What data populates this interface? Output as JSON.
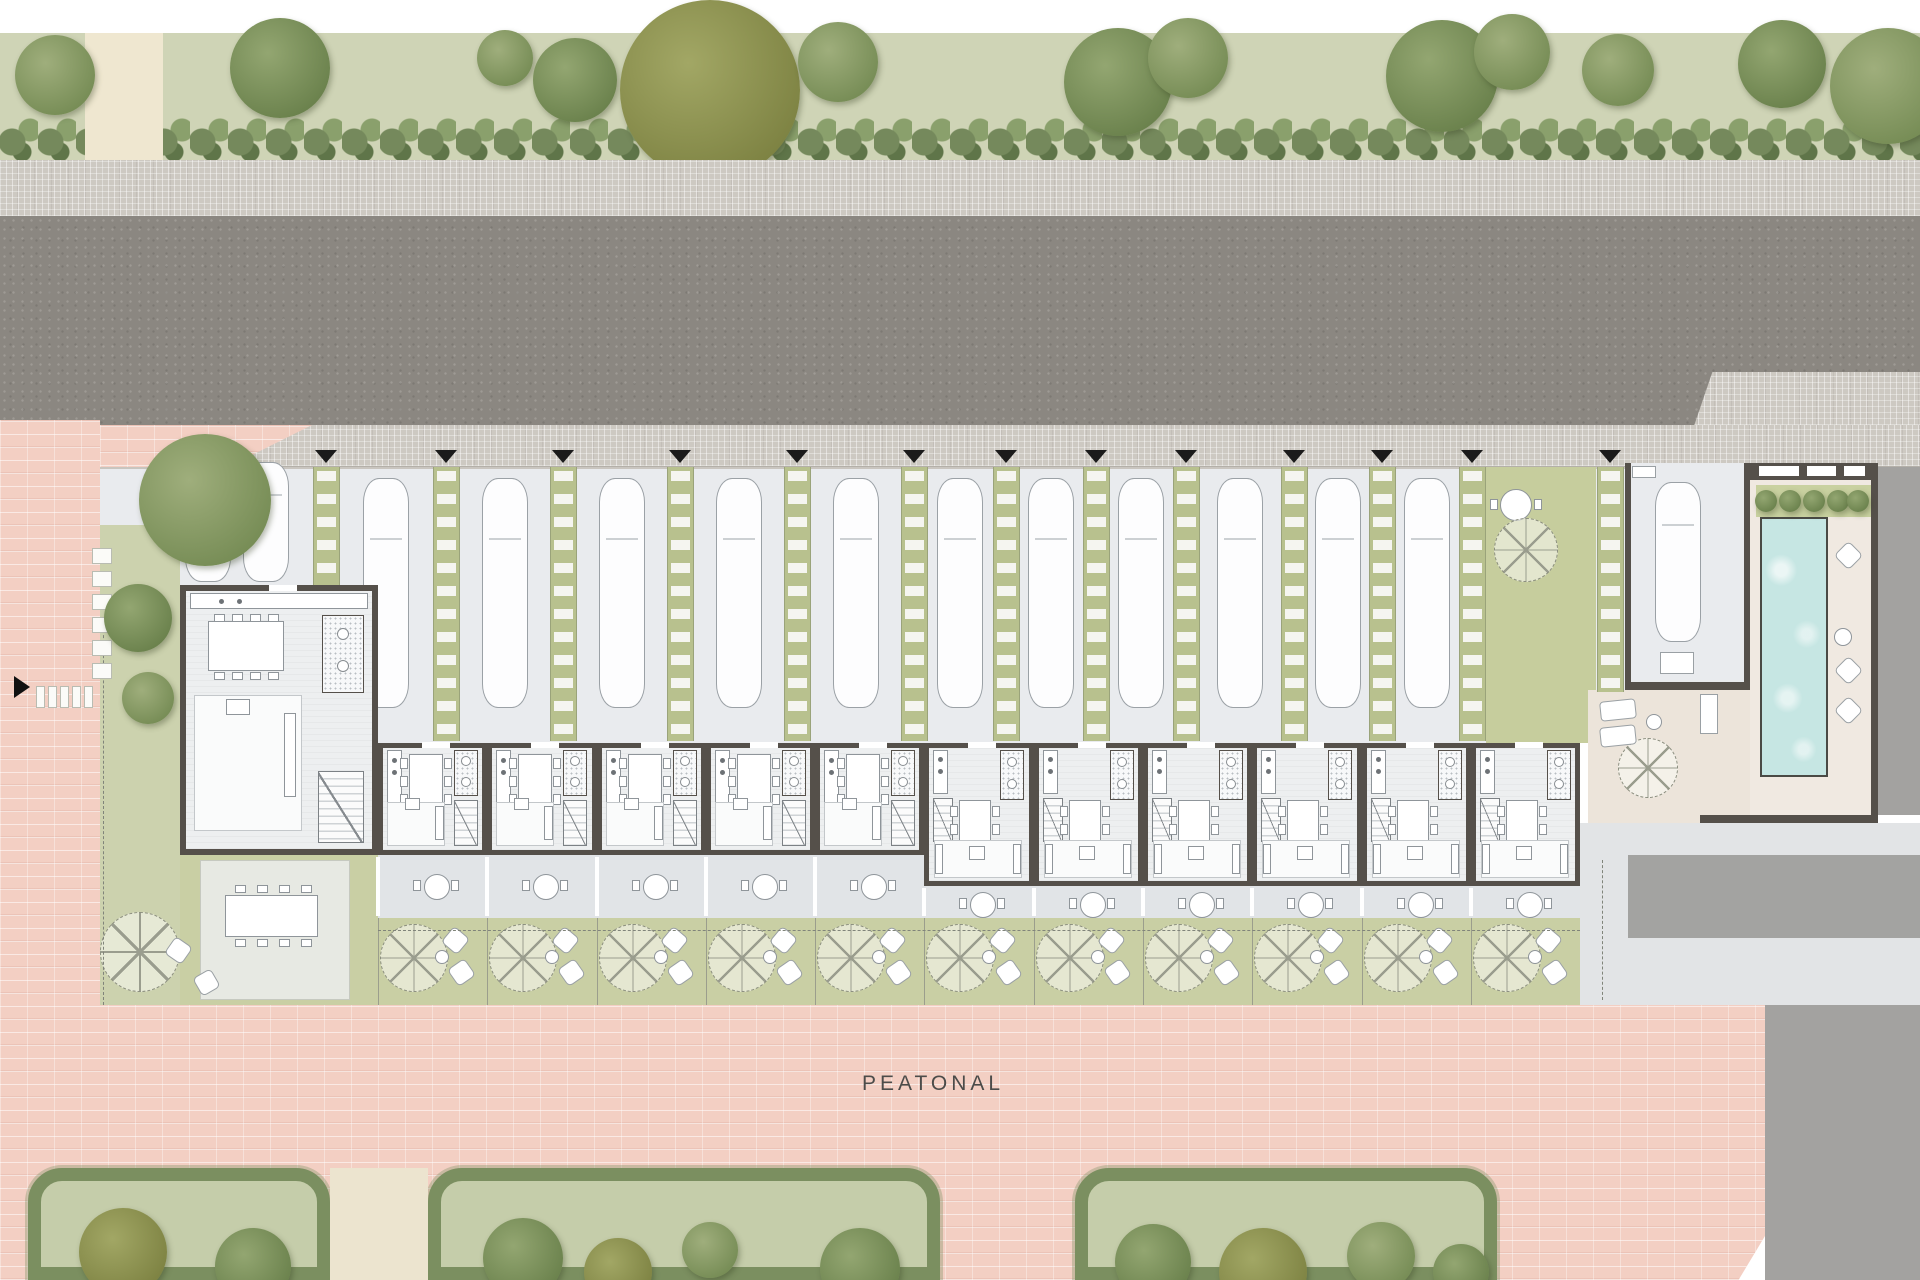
{
  "labels": {
    "pedestrian_street": "PEATONAL"
  },
  "colors": {
    "asphalt": "#8b8781",
    "sidewalk": "#cdc9c2",
    "parking": "#e9ebee",
    "lawn": "#ccd2ae",
    "hedge": "#7b8f60",
    "pink_paving": "#f3cfc3",
    "wall": "#55504a",
    "floor": "#edeff0",
    "terrace": "#e1e4e7",
    "garden": "#c9cfa4",
    "pool_water": "#c6e6e3",
    "deck": "#f0e9e1",
    "communal_beige": "#ece4da",
    "marker": "#1b1b1b",
    "tree_a": [
      "#9fae7c",
      "#768c55"
    ],
    "tree_b": [
      "#93a671",
      "#6a814c"
    ],
    "tree_olive": [
      "#a2a765",
      "#7d8242"
    ]
  },
  "top_strip": {
    "path": {
      "x": 85,
      "w": 78
    },
    "trees": [
      {
        "x": 55,
        "y": 75,
        "r": 40,
        "c": "a"
      },
      {
        "x": 280,
        "y": 68,
        "r": 50,
        "c": "b"
      },
      {
        "x": 505,
        "y": 58,
        "r": 28,
        "c": "a"
      },
      {
        "x": 575,
        "y": 80,
        "r": 42,
        "c": "b"
      },
      {
        "x": 710,
        "y": 90,
        "r": 90,
        "c": "o"
      },
      {
        "x": 838,
        "y": 62,
        "r": 40,
        "c": "a"
      },
      {
        "x": 1118,
        "y": 82,
        "r": 54,
        "c": "b"
      },
      {
        "x": 1188,
        "y": 58,
        "r": 40,
        "c": "a"
      },
      {
        "x": 1442,
        "y": 76,
        "r": 56,
        "c": "b"
      },
      {
        "x": 1512,
        "y": 52,
        "r": 38,
        "c": "a"
      },
      {
        "x": 1618,
        "y": 70,
        "r": 36,
        "c": "a"
      },
      {
        "x": 1782,
        "y": 64,
        "r": 44,
        "c": "b"
      },
      {
        "x": 1888,
        "y": 86,
        "r": 58,
        "c": "a"
      }
    ]
  },
  "parking": {
    "strips": [
      {
        "x": 326
      },
      {
        "x": 446
      },
      {
        "x": 563
      },
      {
        "x": 680
      },
      {
        "x": 797
      },
      {
        "x": 914
      },
      {
        "x": 1006
      },
      {
        "x": 1096
      },
      {
        "x": 1186
      },
      {
        "x": 1294
      },
      {
        "x": 1382
      },
      {
        "x": 1472
      },
      {
        "x": 1610,
        "h": 225
      }
    ],
    "markers": [
      326,
      446,
      563,
      680,
      797,
      914,
      1006,
      1096,
      1186,
      1294,
      1382,
      1472,
      1610
    ],
    "cars": [
      {
        "x": 208,
        "y": 462,
        "l": 120
      },
      {
        "x": 266,
        "y": 462,
        "l": 120
      },
      {
        "x": 386
      },
      {
        "x": 505
      },
      {
        "x": 622
      },
      {
        "x": 739
      },
      {
        "x": 856
      },
      {
        "x": 960
      },
      {
        "x": 1051
      },
      {
        "x": 1141
      },
      {
        "x": 1240
      },
      {
        "x": 1338
      },
      {
        "x": 1427
      },
      {
        "x": 1678,
        "y": 482,
        "l": 160
      }
    ]
  },
  "units": [
    {
      "x": 180,
      "w": 198,
      "type": "end"
    },
    {
      "x": 378,
      "w": 109,
      "type": "A"
    },
    {
      "x": 487,
      "w": 110,
      "type": "A"
    },
    {
      "x": 597,
      "w": 109,
      "type": "A"
    },
    {
      "x": 706,
      "w": 109,
      "type": "A"
    },
    {
      "x": 815,
      "w": 109,
      "type": "A"
    },
    {
      "x": 924,
      "w": 110,
      "type": "B"
    },
    {
      "x": 1034,
      "w": 109,
      "type": "B"
    },
    {
      "x": 1143,
      "w": 109,
      "type": "B"
    },
    {
      "x": 1252,
      "w": 110,
      "type": "B"
    },
    {
      "x": 1362,
      "w": 109,
      "type": "B"
    },
    {
      "x": 1471,
      "w": 109,
      "type": "B"
    }
  ],
  "left_edge": {
    "stepping_column": {
      "x": 92,
      "y": 548,
      "count": 6,
      "w": 20,
      "h": 16,
      "gap": 7
    },
    "stepping_row": {
      "x": 36,
      "y": 686,
      "count": 5,
      "w": 9,
      "h": 22,
      "gap": 3
    },
    "trees": [
      {
        "x": 138,
        "y": 618,
        "r": 34,
        "c": "b"
      },
      {
        "x": 148,
        "y": 698,
        "r": 26,
        "c": "a"
      },
      {
        "x": 205,
        "y": 500,
        "r": 66,
        "c": "a"
      }
    ]
  },
  "courtyard": {
    "table": {
      "x": 1516,
      "y": 505,
      "r": 16
    },
    "parasol": {
      "x": 1526,
      "y": 550,
      "r": 32
    }
  },
  "pool_area": {
    "windows": [
      {
        "x": 1758,
        "w": 42
      },
      {
        "x": 1806,
        "w": 31
      },
      {
        "x": 1843,
        "w": 23
      }
    ],
    "palms": [
      1766,
      1790,
      1814,
      1838,
      1858
    ],
    "cushions": [
      545,
      660,
      700
    ],
    "ball_y": 628
  },
  "communal": {
    "parasol": {
      "x": 1648,
      "y": 768,
      "r": 30
    },
    "loungers_y": [
      700,
      726
    ],
    "ball": {
      "x": 1646,
      "y": 714
    }
  },
  "bottom_strip": {
    "path": {
      "x": 330,
      "w": 98
    },
    "blocks": [
      {
        "x": 28,
        "w": 302,
        "trees": [
          {
            "dx": 95,
            "y": 1252,
            "r": 44,
            "c": "o"
          },
          {
            "dx": 225,
            "y": 1266,
            "r": 38,
            "c": "b"
          }
        ]
      },
      {
        "x": 428,
        "w": 512,
        "trees": [
          {
            "dx": 95,
            "y": 1258,
            "r": 40,
            "c": "b"
          },
          {
            "dx": 190,
            "y": 1272,
            "r": 34,
            "c": "o"
          },
          {
            "dx": 282,
            "y": 1250,
            "r": 28,
            "c": "a"
          },
          {
            "dx": 432,
            "y": 1268,
            "r": 40,
            "c": "b"
          }
        ]
      },
      {
        "x": 1075,
        "w": 422,
        "trees": [
          {
            "dx": 78,
            "y": 1262,
            "r": 38,
            "c": "b"
          },
          {
            "dx": 188,
            "y": 1272,
            "r": 44,
            "c": "o"
          },
          {
            "dx": 306,
            "y": 1256,
            "r": 34,
            "c": "a"
          },
          {
            "dx": 386,
            "y": 1272,
            "r": 28,
            "c": "b"
          }
        ]
      }
    ]
  },
  "yard1": {
    "table": {
      "x": 225,
      "y": 895,
      "w": 93,
      "h": 42
    },
    "tree": {
      "x": 140,
      "y": 952,
      "r": 40
    }
  }
}
